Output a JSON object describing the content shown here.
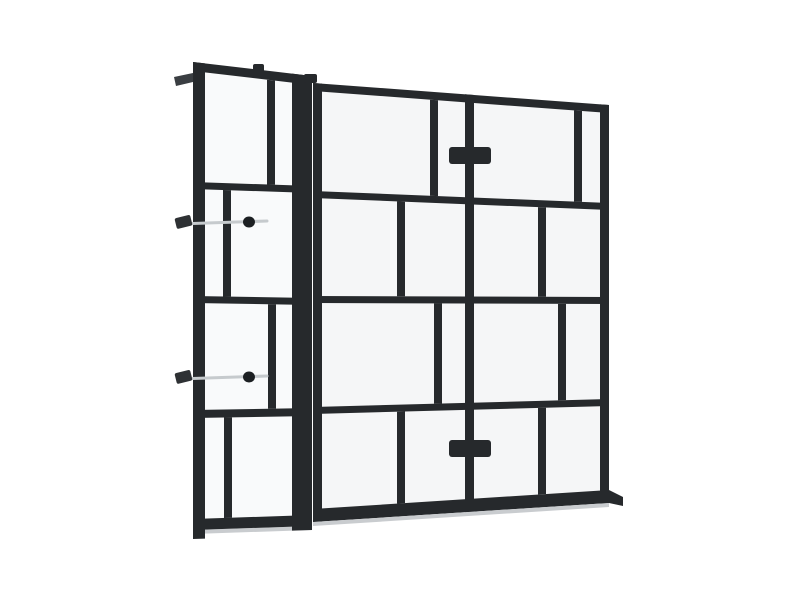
{
  "scene": {
    "subject": "black-framed walk-in glass shower screen product render",
    "background": "#ffffff"
  },
  "colors": {
    "frame": "#26292c",
    "frame_highlight": "#3a3e42",
    "glass_main": "#f5f6f7",
    "glass_door": "#f9fafb",
    "rod": "#c6cacd",
    "rod_tip": "#2e3134",
    "knob": "#1c1f22",
    "shadow": "#c9cccf"
  },
  "main_panel": {
    "x_left": 313,
    "x_right": 609,
    "rails": [
      {
        "y_left": 83,
        "y_right": 105,
        "th": 8
      },
      {
        "y_left": 191,
        "y_right": 203,
        "th": 7
      },
      {
        "y_left": 296,
        "y_right": 297,
        "th": 7
      },
      {
        "y_left": 407,
        "y_right": 399,
        "th": 7
      },
      {
        "y_left": 509,
        "y_right": 490,
        "th": 13
      }
    ],
    "stiles": [
      {
        "x": 313,
        "w": 9,
        "bottom_extend": 0
      },
      {
        "x": 465,
        "w": 9,
        "bottom_extend": 0
      },
      {
        "x": 600,
        "w": 9,
        "bottom_extend": 0
      }
    ],
    "muntins": [
      {
        "row": 0,
        "x": 430,
        "w": 8
      },
      {
        "row": 0,
        "x": 574,
        "w": 8
      },
      {
        "row": 1,
        "x": 397,
        "w": 8
      },
      {
        "row": 1,
        "x": 538,
        "w": 8
      },
      {
        "row": 2,
        "x": 434,
        "w": 8
      },
      {
        "row": 2,
        "x": 558,
        "w": 8
      },
      {
        "row": 3,
        "x": 397,
        "w": 8
      },
      {
        "row": 3,
        "x": 538,
        "w": 8
      }
    ]
  },
  "door_panel": {
    "x_left": 193,
    "x_right": 312,
    "rails": [
      {
        "y_left": 62,
        "y_right": 76,
        "th": 9
      },
      {
        "y_left": 182,
        "y_right": 186,
        "th": 7
      },
      {
        "y_left": 296,
        "y_right": 298,
        "th": 7
      },
      {
        "y_left": 410,
        "y_right": 408,
        "th": 8
      },
      {
        "y_left": 519,
        "y_right": 515,
        "th": 11
      }
    ],
    "stiles": [
      {
        "x": 193,
        "w": 12,
        "bottom_extend": 9
      },
      {
        "x": 292,
        "w": 20,
        "bottom_extend": 4
      }
    ],
    "muntins": [
      {
        "row": 0,
        "x": 267,
        "w": 8
      },
      {
        "row": 1,
        "x": 223,
        "w": 8
      },
      {
        "row": 2,
        "x": 268,
        "w": 8
      },
      {
        "row": 3,
        "x": 224,
        "w": 8
      }
    ]
  },
  "handles": [
    {
      "x": 449,
      "y": 147,
      "w": 42,
      "h": 17
    },
    {
      "x": 449,
      "y": 440,
      "w": 42,
      "h": 17
    }
  ],
  "stabilizer_bars": [
    {
      "y": 222,
      "x_start": 178,
      "x_end": 267,
      "ball_x": 249,
      "tip": {
        "x": 175.5,
        "y": 216.5,
        "w": 16,
        "h": 11,
        "angle": -14,
        "cx": 183,
        "cy": 222
      }
    },
    {
      "y": 377,
      "x_start": 178,
      "x_end": 267,
      "ball_x": 249,
      "tip": {
        "x": 175.5,
        "y": 371.5,
        "w": 16,
        "h": 11,
        "angle": -14,
        "cx": 183,
        "cy": 377
      }
    }
  ],
  "details": {
    "top_tab": {
      "x": 253,
      "y": 64,
      "w": 11,
      "h": 12
    },
    "stile_cap": {
      "x": 304,
      "y": 74,
      "w": 13,
      "h": 9
    },
    "wall_stub_points": "174,77 193,73 193,82 176,86",
    "foot_points": "609,490 623,497 623,506 609,503",
    "main_sill_shadow_points": "313,522 609,503 609,507 313,526",
    "door_sill_shadow_points": "193,530 312,526 312,530 193,534"
  }
}
